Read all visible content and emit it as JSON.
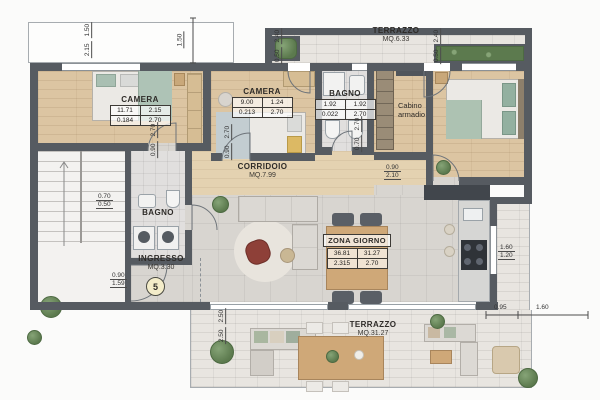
{
  "labels": {
    "camera1": {
      "name": "CAMERA",
      "r1c1": "11.71",
      "r1c2": "2.15",
      "r2c1": "0.184",
      "r2c2": "2.70"
    },
    "camera2": {
      "name": "CAMERA",
      "r1c1": "9.00",
      "r1c2": "1.24",
      "r2c1": "0.213",
      "r2c2": "2.70"
    },
    "bagno1": {
      "name": "BAGNO",
      "r1c1": "1.92",
      "r1c2": "1.92",
      "r2c1": "0.022",
      "r2c2": "2.70"
    },
    "bagno2": {
      "name": "BAGNO"
    },
    "cabina": {
      "line1": "Cabino",
      "line2": "armadio"
    },
    "corridoio": {
      "name": "CORRIDOIO",
      "area": "MQ.7.99"
    },
    "ingresso": {
      "name": "INGRESSO",
      "area": "MQ.3.30",
      "badge": "5"
    },
    "zona": {
      "name": "ZONA GIORNO",
      "r1c1": "36.81",
      "r1c2": "31.27",
      "r2c1": "2.315",
      "r2c2": "2.70"
    },
    "terr_top": {
      "name": "TERRAZZO",
      "area": "MQ.6.33"
    },
    "terr_btm": {
      "name": "TERRAZZO",
      "area": "MQ.31.27"
    }
  },
  "dims": {
    "d1a": "2.15",
    "d1b": "1.50",
    "d2": "1.50",
    "d3a": "0.50",
    "d3b": "2.40",
    "d4a": "0.50",
    "d4b": "2.40",
    "d5a": "0.90",
    "d5b": "2.70",
    "d6a": "0.90",
    "d6b": "2.70",
    "d7a": "0.70",
    "d7b": "2.70",
    "d8a": "0.90",
    "d8b": "2.10",
    "d9a": "0.70",
    "d9b": "0.50",
    "d10a": "0.90",
    "d10b": "1.59",
    "d11a": "1.60",
    "d11b": "1.20",
    "d12a": "2.50",
    "d12b": "2.50",
    "d13": "0.95",
    "d14": "1.60"
  },
  "colors": {
    "wall": "#565b61",
    "wood": "#dcc5a2",
    "stone": "#d8d5d0",
    "terrace": "#e8e5e0",
    "greenery": "#5c7a4e",
    "accent_chair": "#8e4038",
    "table_wood": "#cfa878"
  }
}
